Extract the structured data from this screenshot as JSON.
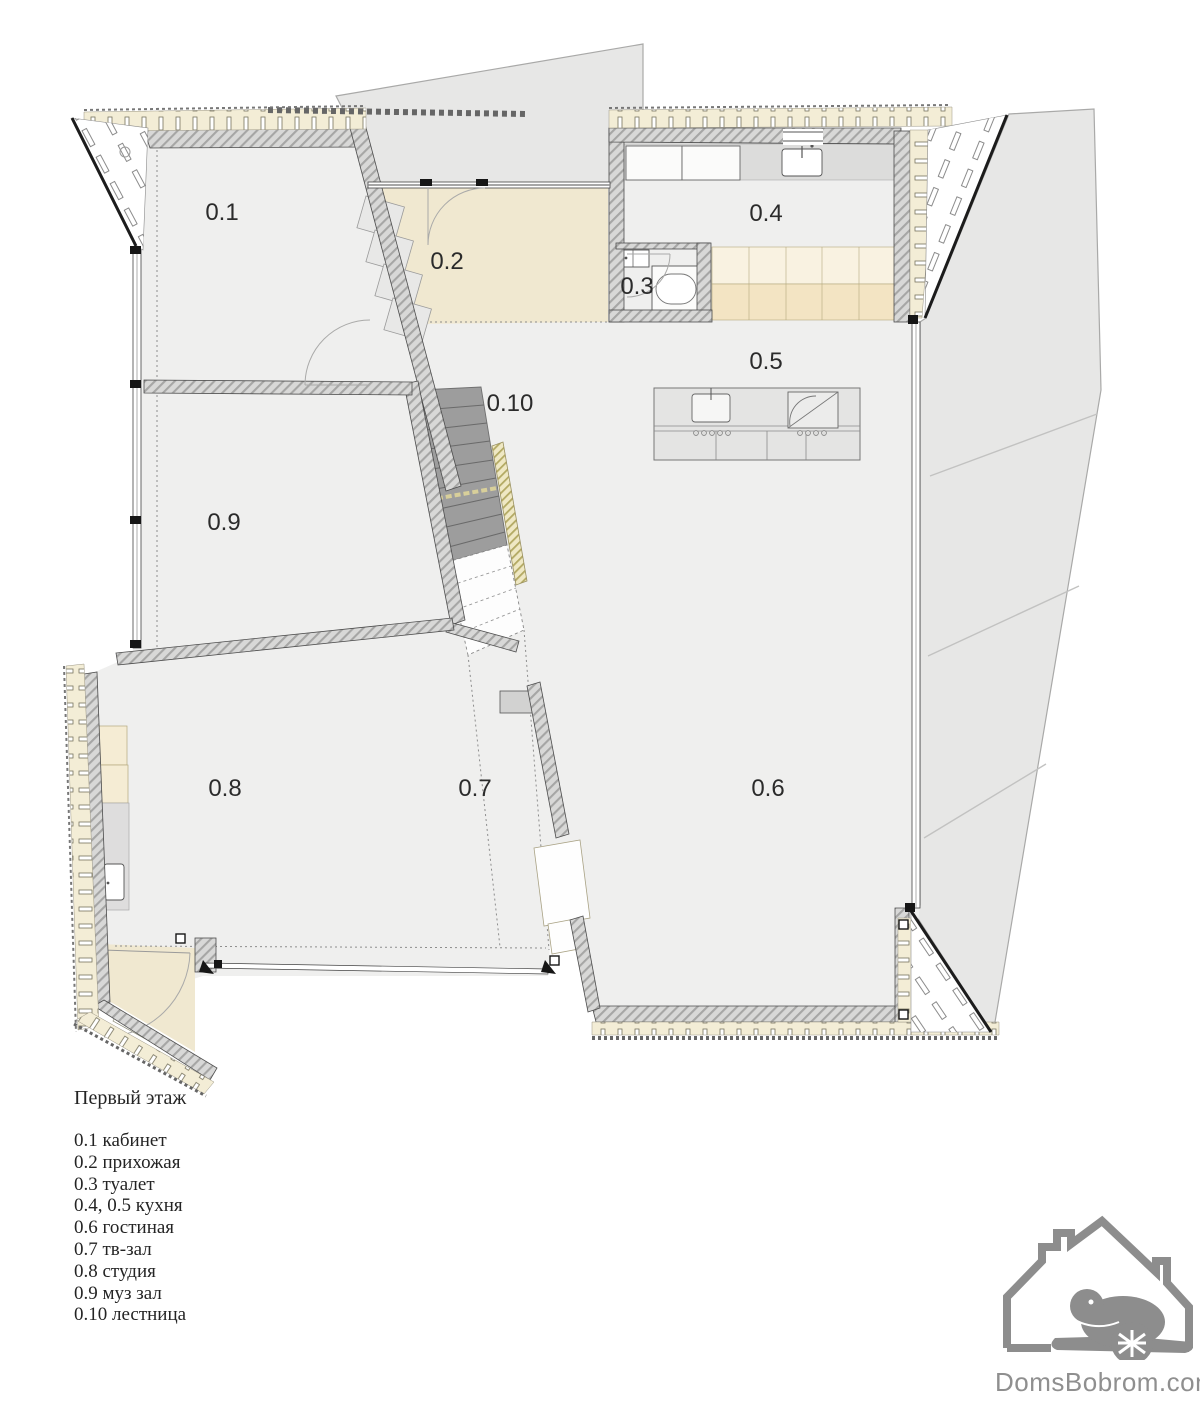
{
  "legend": {
    "title": "Первый этаж",
    "items": [
      "0.1 кабинет",
      "0.2 прихожая",
      "0.3 туалет",
      "0.4, 0.5 кухня",
      "0.6 гостиная",
      "0.7 тв-зал",
      "0.8 студия",
      "0.9 муз зал",
      "0.10 лестница"
    ]
  },
  "rooms": {
    "r01": {
      "label": "0.1"
    },
    "r02": {
      "label": "0.2"
    },
    "r03": {
      "label": "0.3"
    },
    "r04": {
      "label": "0.4"
    },
    "r05": {
      "label": "0.5"
    },
    "r06": {
      "label": "0.6"
    },
    "r07": {
      "label": "0.7"
    },
    "r08": {
      "label": "0.8"
    },
    "r09": {
      "label": "0.9"
    },
    "r10": {
      "label": "0.10"
    }
  },
  "branding": {
    "site": "DomsBobrom.com"
  },
  "colors": {
    "floor_gray": "#efefee",
    "entry_beige": "#f0e8d0",
    "terrace_gray": "#e7e7e6",
    "wall_hatch": "#d8d8d7",
    "insulation_cream": "#f3edd6",
    "stair_gray": "#9d9d9d",
    "logo_gray": "#8d8d8d"
  }
}
